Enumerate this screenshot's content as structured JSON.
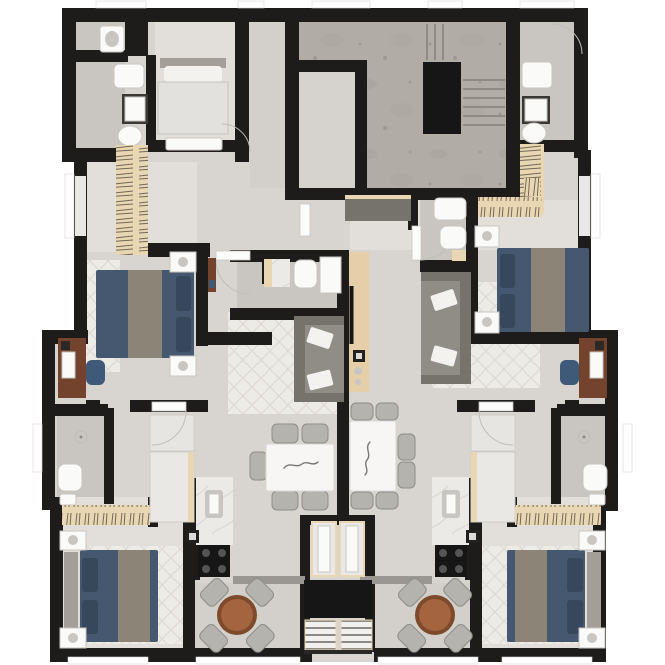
{
  "meta": {
    "title": "apartment-building-floor-plan",
    "view": "top-down-3d-render",
    "canvas": {
      "width": 665,
      "height": 665
    }
  },
  "colors": {
    "page_bg": "#ffffff",
    "wall": "#1e1c1a",
    "floor": "#d8d5d1",
    "floor_light": "#e2dfdb",
    "floor_dark": "#c9c6c2",
    "corridor": "#d3d0cc",
    "concrete": "#b1aca6",
    "concrete_dark": "#8f8a84",
    "lobby": "#d6d3cf",
    "rug": "#edebe6",
    "rug_line": "#ddd9d3",
    "bed_navy": "#46586f",
    "bed_navy_dark": "#37475c",
    "blanket_gray": "#8d8478",
    "headboard": "#a39f98",
    "sofa": "#8f8d86",
    "sofa_dark": "#75736b",
    "pillow_white": "#f3f2ef",
    "closet_tan": "#e9d6b2",
    "closet_line": "#4a4238",
    "media_tan": "#e6cfa8",
    "desk_brown": "#74432e",
    "chair_navy": "#3f5a78",
    "table_white": "#f7f6f4",
    "chair_gray": "#b5b3ae",
    "chair_gray_dark": "#8f8d88",
    "round_table": "#a4643f",
    "round_table_dark": "#7e4a2c",
    "marble": "#eceae7",
    "appliance_black": "#161616",
    "fixture_white": "#fafaf8",
    "fixture_gray": "#c9c6c2",
    "glass": "#e9e8e6",
    "sill_white": "#ffffff",
    "door_white": "#fcfcfb",
    "arc_gray": "#c0bdb8",
    "metal_gray": "#9a9792"
  },
  "plan": {
    "core": {
      "name": "circulation-core",
      "features": [
        "staircase-with-treads",
        "elevator-shaft",
        "concrete-landing",
        "lobby"
      ]
    },
    "unit_upper_left": {
      "rooms": [
        "small-bedroom",
        "bathroom",
        "hall",
        "double-bedroom",
        "wardrobe-closet",
        "en-suite-bathroom",
        "living-room",
        "dining-area",
        "kitchen",
        "desk-nook",
        "guest-bathroom"
      ],
      "furniture": [
        "single-bed",
        "double-bed-navy",
        "nightstands-with-lamps",
        "hanging-closet",
        "gray-sofa-white-pillows",
        "patterned-rug",
        "tv-media-wall",
        "white-dining-table",
        "dining-chairs-5",
        "kitchen-counter-sink",
        "black-cooktop",
        "wood-desk",
        "navy-desk-chair",
        "toilet",
        "shower",
        "sink"
      ]
    },
    "unit_upper_right": {
      "rooms": [
        "bathroom",
        "hall",
        "double-bedroom",
        "wardrobe-closet",
        "living-room",
        "dining-area",
        "kitchen",
        "desk-nook",
        "guest-bathroom"
      ],
      "furniture": [
        "double-bed-navy",
        "nightstands-with-lamps",
        "hanging-closet",
        "gray-sofa-white-pillows",
        "patterned-rug",
        "dark-sideboard",
        "white-dining-table",
        "dining-chairs-6",
        "kitchen-counter-sink",
        "black-cooktop",
        "wood-desk",
        "navy-desk-chair",
        "toilet",
        "shower",
        "sink"
      ]
    },
    "studio_lower_left": {
      "rooms": [
        "bedroom",
        "balcony"
      ],
      "furniture": [
        "double-bed-navy-gray-headboard",
        "hanging-closet",
        "nightstands-with-lamps",
        "round-wood-table",
        "balcony-chairs-4",
        "sliding-door"
      ]
    },
    "studio_lower_right": {
      "rooms": [
        "bedroom",
        "balcony"
      ],
      "furniture": [
        "double-bed-navy-gray-headboard",
        "hanging-closet",
        "nightstands-with-lamps",
        "round-wood-table",
        "balcony-chairs-4",
        "sliding-door"
      ]
    },
    "service_shaft": {
      "features": [
        "glass-doors",
        "dark-duct",
        "ac-condenser-units-2"
      ]
    },
    "openings": {
      "windows": "white sills on top, side and bottom facades",
      "doors": "white leaves with swing arcs"
    }
  }
}
